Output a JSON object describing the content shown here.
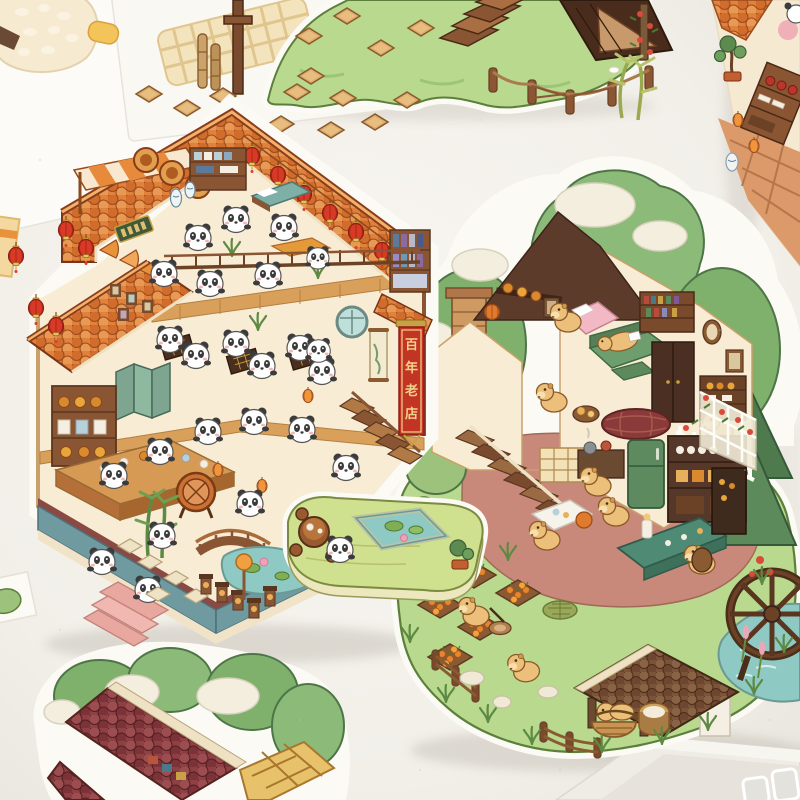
{
  "scene": {
    "kind": "photo-of-die-cut-sticker-sheets",
    "stickers": {
      "panda_teahouse": {
        "label": "panda teahouse sticker",
        "banner_text": "百年老店"
      },
      "capybara_cottage": {
        "label": "capybara cottage garden sticker"
      },
      "grass_mound": {
        "label": "grass hill path sticker"
      },
      "red_roof_corner": {
        "label": "red roof cottage sticker (partial)"
      },
      "shelf_sheet": {
        "label": "tea-shop shelves sticker sheet (partial)"
      }
    }
  },
  "banner": {
    "char1": "百",
    "char2": "年",
    "char3": "老",
    "char4": "店",
    "full": "百年老店"
  },
  "figures": {
    "panda": "panda-figure",
    "capybara": "capybara-figure",
    "lantern": "red-lantern-icon"
  },
  "palette": {
    "surface": "#f3f0ea",
    "card-white": "#fcfbf7",
    "roof-orange": "#e0813c",
    "roof-maroon": "#6e3a42",
    "wall-cream": "#f8ecd4",
    "wood-brown": "#8a5532",
    "wood-dark": "#5a3620",
    "lantern-red": "#d93a26",
    "banner-red": "#c23524",
    "gold-trim": "#f0d48a",
    "grass-light": "#b9d98e",
    "grass-edge": "#5d7f3c",
    "leaf-green": "#7fb06c",
    "pine-green": "#4e7a4e",
    "cloud-cream": "#f3eedd",
    "water-teal": "#8fc9c3",
    "platform-teal": "#6f9aa0",
    "stripe-maroon": "#8a4a44",
    "stair-pink": "#e8a79f",
    "capybara-tan": "#ecc07a",
    "patio-clay": "#c9897a",
    "soil-brown": "#8a5a35",
    "key-gray": "#e4e2dd"
  }
}
